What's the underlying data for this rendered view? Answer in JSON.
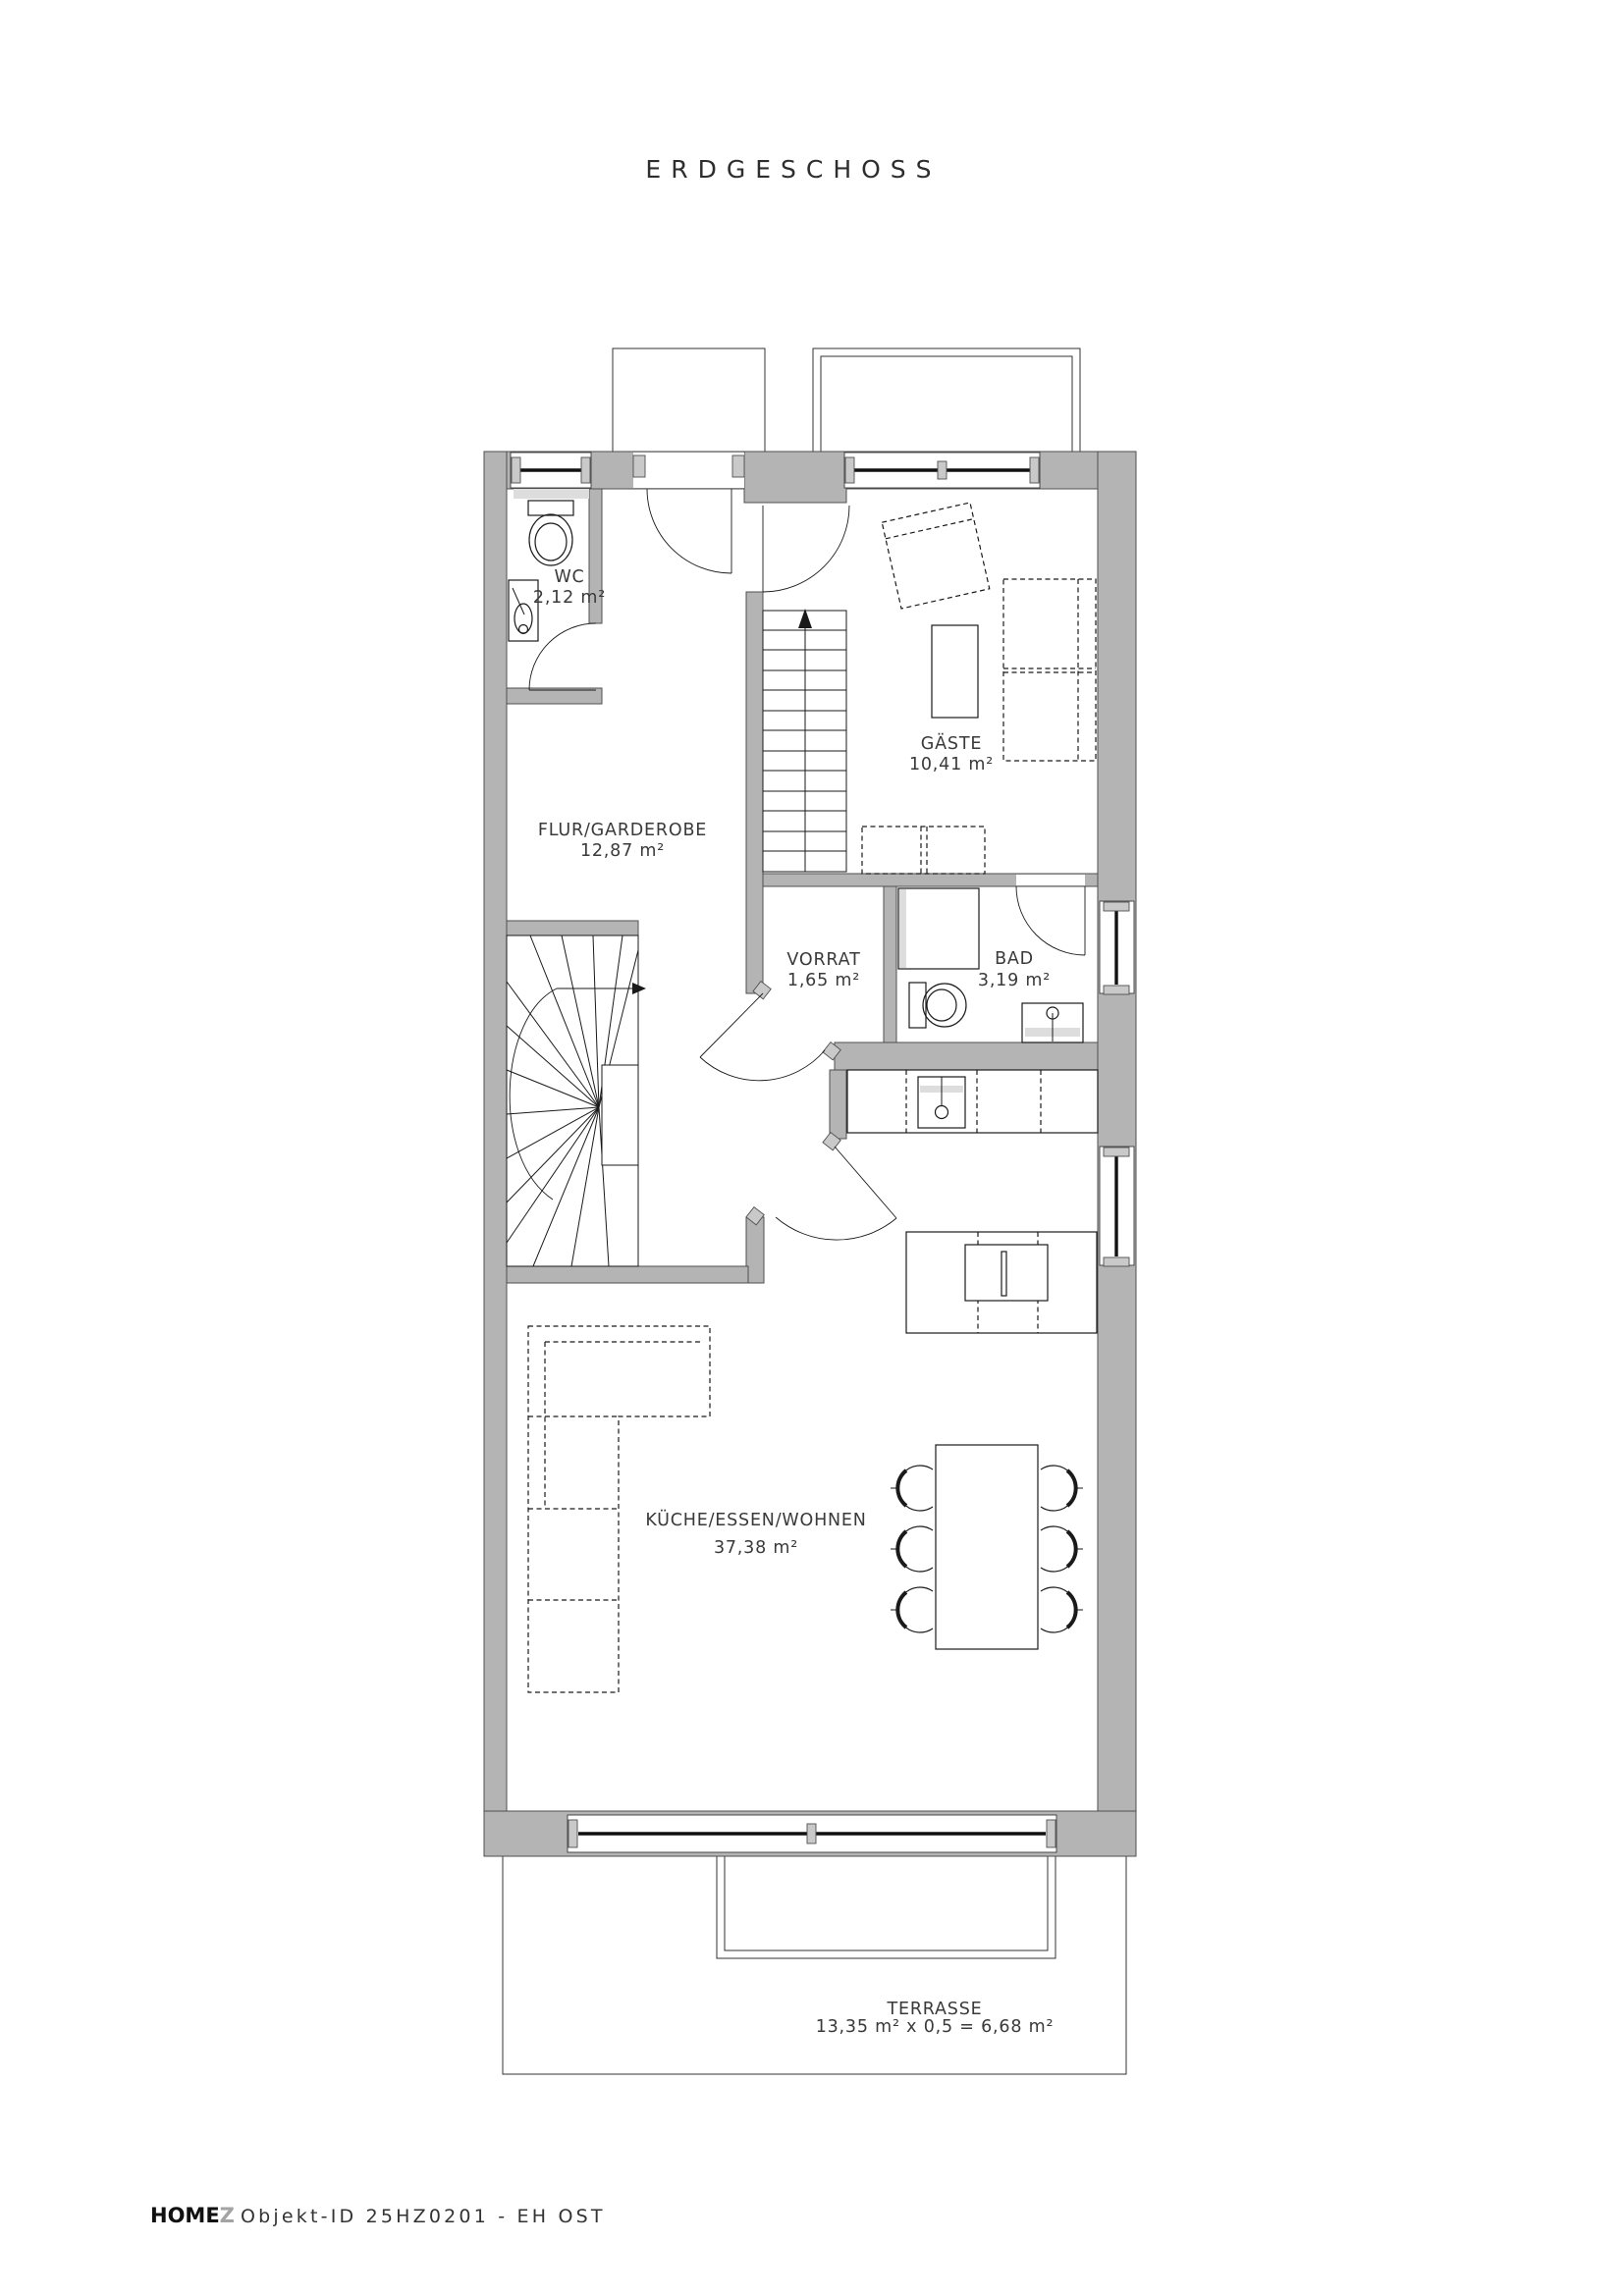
{
  "title": "ERDGESCHOSS",
  "rooms": {
    "wc": {
      "name": "WC",
      "area": "2,12 m²"
    },
    "flur": {
      "name": "FLUR/GARDEROBE",
      "area": "12,87 m²"
    },
    "gaeste": {
      "name": "GÄSTE",
      "area": "10,41 m²"
    },
    "vorrat": {
      "name": "VORRAT",
      "area": "1,65 m²"
    },
    "bad": {
      "name": "BAD",
      "area": "3,19 m²"
    },
    "kueche": {
      "name": "KÜCHE/ESSEN/WOHNEN",
      "area": "37,38 m²"
    },
    "terrasse": {
      "name": "TERRASSE",
      "area": "13,35 m² x 0,5 = 6,68 m²"
    }
  },
  "footer": {
    "brand": "HOME",
    "brand_suffix": "Z",
    "object_id": "Objekt-ID 25HZ0201 - EH OST"
  },
  "colors": {
    "wall_fill": "#b4b4b4",
    "wall_outline": "#4f4f4f",
    "line": "#1a1a1a",
    "light_gray": "#dddddd",
    "text": "#3a3a3a",
    "brand_accent": "#a3a3a3"
  }
}
